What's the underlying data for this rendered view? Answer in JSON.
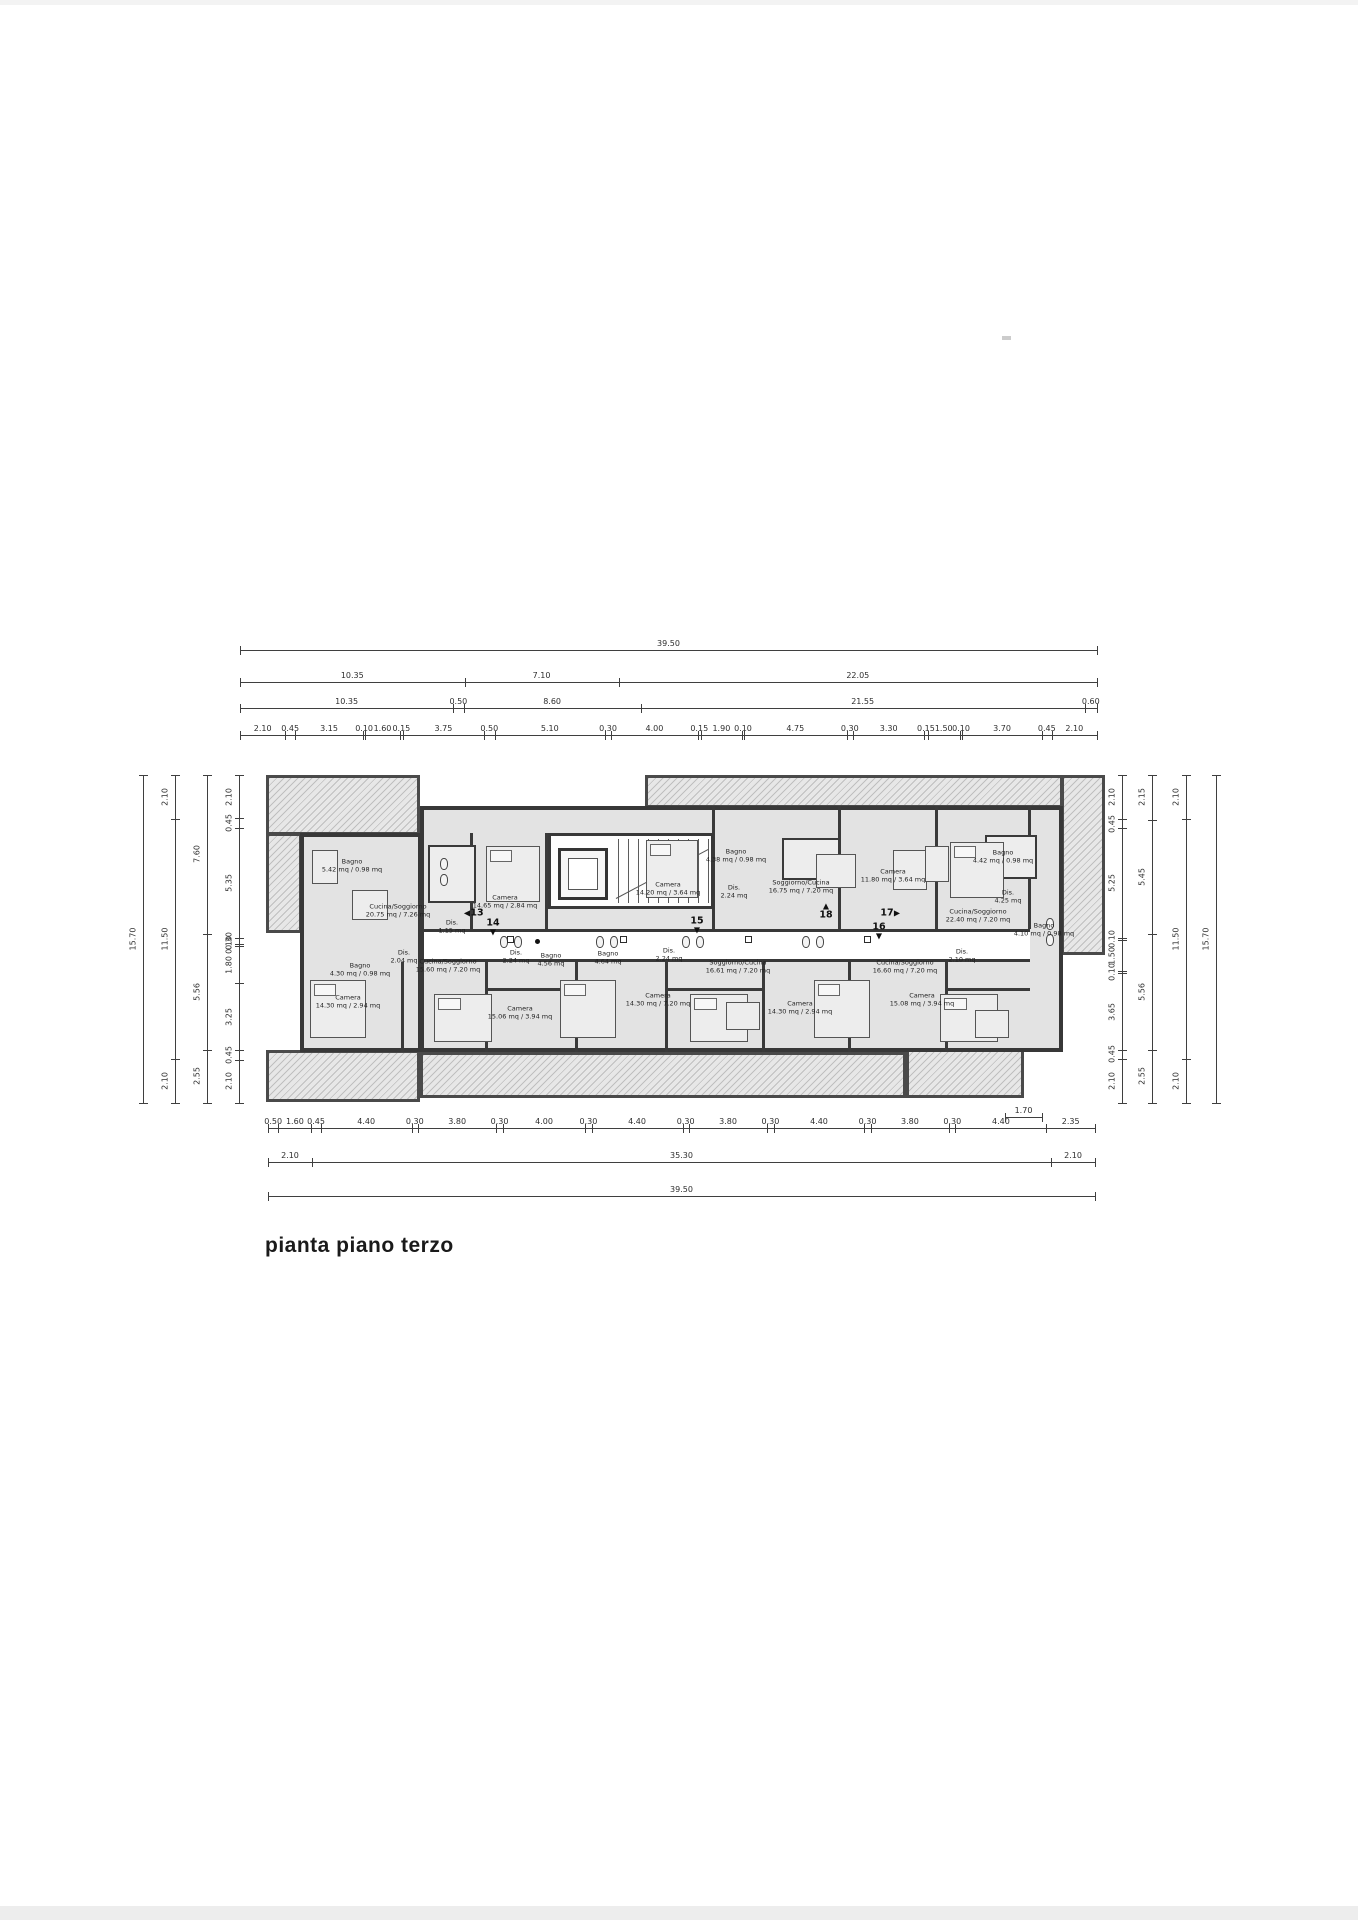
{
  "page": {
    "title_block": "pianta piano terzo"
  },
  "colors": {
    "line": "#3a3a3a",
    "room_fill": "#e3e3e3",
    "hatch_fill": "#d9d9d9",
    "paper": "#ffffff"
  },
  "dimensions": {
    "top_rows": [
      [
        "39.50"
      ],
      [
        "10.35",
        "7.10",
        "22.05"
      ],
      [
        "10.35",
        "0.50",
        "8.60",
        "21.55",
        "0.60"
      ],
      [
        "2.10",
        "0.45",
        "3.15",
        "0.10",
        "1.60",
        "0.15",
        "3.75",
        "0.50",
        "5.10",
        "0.30",
        "4.00",
        "0.15",
        "1.90",
        "0.10",
        "4.75",
        "0.30",
        "3.30",
        "0.15",
        "1.50",
        "0.10",
        "3.70",
        "0.45",
        "2.10"
      ]
    ],
    "bottom_rows": [
      [
        "0.50",
        "1.60",
        "0.45",
        "4.40",
        "0.30",
        "3.80",
        "0.30",
        "4.00",
        "0.30",
        "4.40",
        "0.30",
        "3.80",
        "0.30",
        "4.40",
        "0.30",
        "3.80",
        "0.30",
        "4.40",
        "2.35"
      ],
      [
        "2.10",
        "35.30",
        "2.10"
      ],
      [
        "39.50"
      ]
    ],
    "bottom_inset": [
      "1.70"
    ],
    "left_columns": [
      [
        "15.70"
      ],
      [
        "2.10",
        "11.50",
        "2.10"
      ],
      [
        "7.60",
        "5.56",
        "2.55"
      ],
      [
        "2.10",
        "0.45",
        "5.35",
        "0.30",
        "0.10",
        "1.80",
        "3.25",
        "0.45",
        "2.10"
      ]
    ],
    "right_columns": [
      [
        "2.10",
        "0.45",
        "5.25",
        "0.10",
        "1.50",
        "0.10",
        "3.65",
        "0.45",
        "2.10"
      ],
      [
        "2.15",
        "5.45",
        "5.56",
        "2.55"
      ],
      [
        "2.10",
        "11.50",
        "2.10"
      ],
      [
        "15.70"
      ]
    ]
  },
  "corridor": {
    "unit_labels": [
      {
        "label": "13",
        "arrow": "left",
        "x": 477,
        "y": 913
      },
      {
        "label": "14",
        "arrow": "down",
        "x": 493,
        "y": 923
      },
      {
        "label": "15",
        "arrow": "down",
        "x": 697,
        "y": 921
      },
      {
        "label": "18",
        "arrow": "up",
        "x": 826,
        "y": 915
      },
      {
        "label": "17",
        "arrow": "right",
        "x": 887,
        "y": 913
      },
      {
        "label": "16",
        "arrow": "down",
        "x": 879,
        "y": 927
      }
    ]
  },
  "rooms": [
    {
      "lines": [
        "Cucina/Soggiorno",
        "20.75 mq / 7.26 mq"
      ],
      "x": 398,
      "y": 911
    },
    {
      "lines": [
        "Bagno",
        "5.42 mq / 0.98 mq"
      ],
      "x": 352,
      "y": 866
    },
    {
      "lines": [
        "Dis.",
        "1.15 mq"
      ],
      "x": 452,
      "y": 927
    },
    {
      "lines": [
        "Camera",
        "14.65 mq / 2.84 mq"
      ],
      "x": 505,
      "y": 902
    },
    {
      "lines": [
        "Camera",
        "14.20 mq / 3.64 mq"
      ],
      "x": 668,
      "y": 889
    },
    {
      "lines": [
        "Bagno",
        "4.38 mq / 0.98 mq"
      ],
      "x": 736,
      "y": 856
    },
    {
      "lines": [
        "Dis.",
        "2.24 mq"
      ],
      "x": 734,
      "y": 892
    },
    {
      "lines": [
        "Soggiorno/Cucina",
        "16.75 mq / 7.20 mq"
      ],
      "x": 801,
      "y": 887
    },
    {
      "lines": [
        "Camera",
        "11.80 mq / 3.64 mq"
      ],
      "x": 893,
      "y": 876
    },
    {
      "lines": [
        "Bagno",
        "4.42 mq / 0.98 mq"
      ],
      "x": 1003,
      "y": 857
    },
    {
      "lines": [
        "Dis.",
        "4.25 mq"
      ],
      "x": 1008,
      "y": 897
    },
    {
      "lines": [
        "Cucina/Soggiorno",
        "22.40 mq / 7.20 mq"
      ],
      "x": 978,
      "y": 916
    },
    {
      "lines": [
        "Dis.",
        "2.04 mq"
      ],
      "x": 404,
      "y": 957
    },
    {
      "lines": [
        "Bagno",
        "4.30 mq / 0.98 mq"
      ],
      "x": 360,
      "y": 970
    },
    {
      "lines": [
        "Camera",
        "14.30 mq / 2.94 mq"
      ],
      "x": 348,
      "y": 1002
    },
    {
      "lines": [
        "Cucina/Soggiorno",
        "15.60 mq / 7.20 mq"
      ],
      "x": 448,
      "y": 966
    },
    {
      "lines": [
        "Dis.",
        "2.24 mq"
      ],
      "x": 516,
      "y": 957
    },
    {
      "lines": [
        "Bagno",
        "4.56 mq"
      ],
      "x": 551,
      "y": 960
    },
    {
      "lines": [
        "Camera",
        "15.06 mq / 3.94 mq"
      ],
      "x": 520,
      "y": 1013
    },
    {
      "lines": [
        "Bagno",
        "4.64 mq"
      ],
      "x": 608,
      "y": 958
    },
    {
      "lines": [
        "Dis.",
        "2.24 mq"
      ],
      "x": 669,
      "y": 955
    },
    {
      "lines": [
        "Camera",
        "14.30 mq / 7.20 mq"
      ],
      "x": 658,
      "y": 1000
    },
    {
      "lines": [
        "Soggiorno/Cucina",
        "16.61 mq / 7.20 mq"
      ],
      "x": 738,
      "y": 967
    },
    {
      "lines": [
        "Camera",
        "14.30 mq / 2.94 mq"
      ],
      "x": 800,
      "y": 1008
    },
    {
      "lines": [
        "Cucina/Soggiorno",
        "16.60 mq / 7.20 mq"
      ],
      "x": 905,
      "y": 967
    },
    {
      "lines": [
        "Camera",
        "15.08 mq / 3.94 mq"
      ],
      "x": 922,
      "y": 1000
    },
    {
      "lines": [
        "Dis.",
        "2.10 mq"
      ],
      "x": 962,
      "y": 956
    },
    {
      "lines": [
        "Bagno",
        "4.10 mq / 0.98 mq"
      ],
      "x": 1044,
      "y": 930
    }
  ]
}
